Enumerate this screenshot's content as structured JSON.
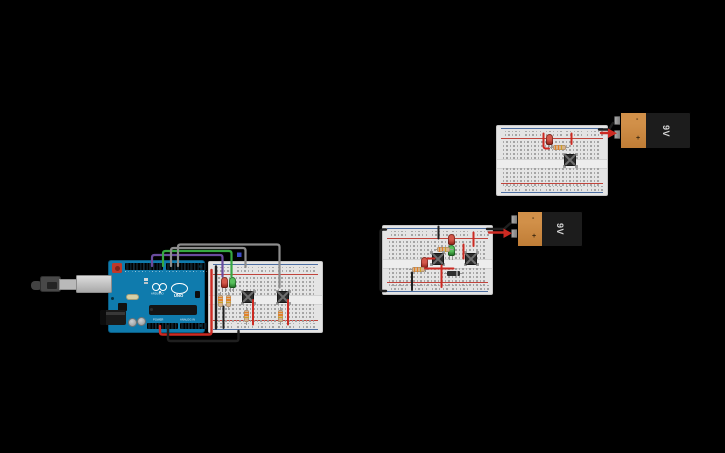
{
  "app": {
    "name": "circuit-canvas",
    "background": "#000000"
  },
  "arduino": {
    "brand_text": "ARDUINO",
    "model_text": "UNO",
    "label_power": "POWER",
    "label_analog_in": "ANALOG IN"
  },
  "batteries": [
    {
      "id": "battery-top-right",
      "label": "9V",
      "minus_sign": "-",
      "plus_sign": "+"
    },
    {
      "id": "battery-middle",
      "label": "9V",
      "minus_sign": "-",
      "plus_sign": "+"
    }
  ],
  "breadboards": [
    {
      "id": "breadboard-left",
      "components": [
        "red LED",
        "green LED",
        "2 pushbuttons",
        "4 resistors",
        "red/black/green/purple/gray jumper wires"
      ]
    },
    {
      "id": "breadboard-top-right",
      "components": [
        "red LED",
        "resistor",
        "pushbutton",
        "red jumper wires",
        "battery leads"
      ]
    },
    {
      "id": "breadboard-middle",
      "components": [
        "2 red LEDs",
        "green LED",
        "2 resistors",
        "diode",
        "2 pushbuttons",
        "red/black jumper wires",
        "battery leads"
      ]
    }
  ],
  "colors": {
    "background": "#000000",
    "wire_red": "#cc2a22",
    "wire_black": "#1f1f1f",
    "wire_green": "#36a842",
    "wire_purple": "#6a4b9e",
    "wire_gray": "#8c8c8c",
    "wire_blue_end": "#3b4bc8",
    "arduino_teal": "#0f7bad",
    "breadboard_gray": "#e4e4e4",
    "battery_orange": "#c9853f",
    "battery_black": "#1c1c1c",
    "led_red": "#9c2b1f",
    "led_green": "#287a2c",
    "resistor_body": "#d7b289"
  }
}
